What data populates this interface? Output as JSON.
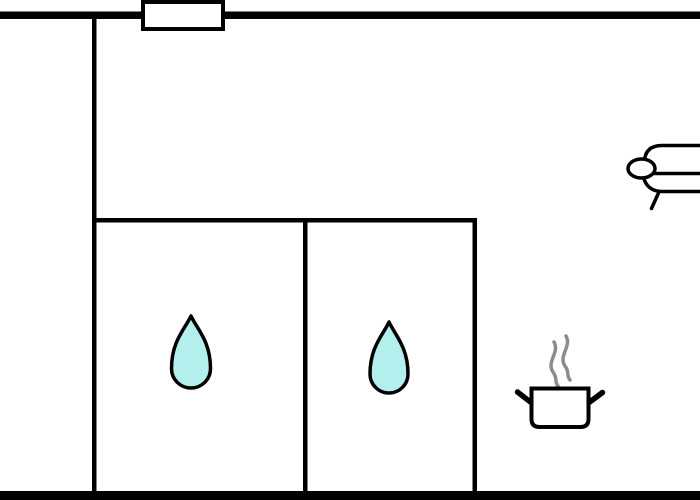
{
  "page": {
    "kind": "floor-plan-diagram",
    "width_px": 700,
    "height_px": 500
  },
  "colors": {
    "background": "#ffffff",
    "wall": "#000000",
    "outline": "#000000",
    "fixture_fill": "#ffffff",
    "water_drop_fill": "#b3f0ed",
    "steam": "#8c8c8c"
  },
  "icons": [
    {
      "name": "window-marker",
      "location": "top-exterior-wall"
    },
    {
      "name": "bed-icon",
      "location": "upper-right-room-cut-off-at-edge"
    },
    {
      "name": "water-drop-icon",
      "location": "lower-left-room"
    },
    {
      "name": "water-drop-icon",
      "location": "lower-middle-room"
    },
    {
      "name": "cooking-pot-icon",
      "location": "lower-right-area"
    },
    {
      "name": "steam-icon",
      "location": "above-cooking-pot"
    }
  ]
}
